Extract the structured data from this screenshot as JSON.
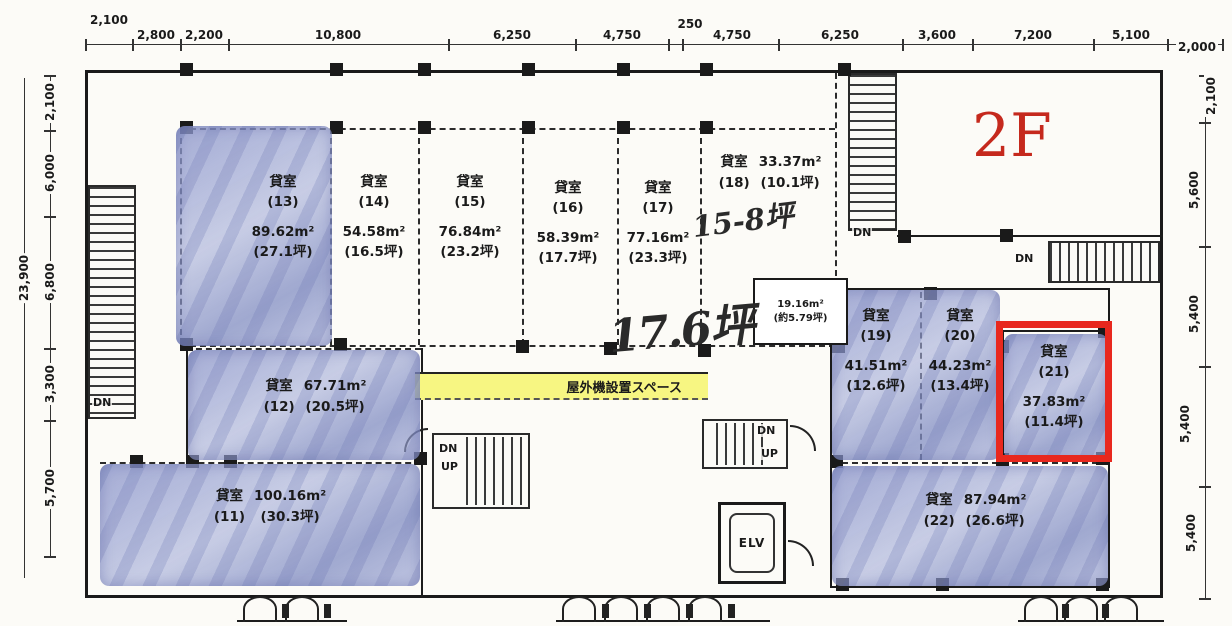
{
  "floor_label": "2F",
  "dimensions": {
    "top": [
      "2,100",
      "2,800",
      "2,200",
      "10,800",
      "6,250",
      "4,750",
      "250",
      "4,750",
      "6,250",
      "3,600",
      "7,200",
      "5,100",
      "2,000"
    ],
    "left": {
      "total": "23,900",
      "segments": [
        "2,100",
        "6,000",
        "6,800",
        "3,300",
        "5,700"
      ]
    },
    "right": {
      "segments": [
        "2,100",
        "5,600",
        "5,400",
        "5,400",
        "5,400"
      ]
    }
  },
  "labels": {
    "room_prefix": "貸室",
    "outdoor_unit_space": "屋外機設置スペース",
    "elevator": "ELV",
    "down": "DN",
    "up": "UP"
  },
  "rooms": [
    {
      "id": "13",
      "num": "(13)",
      "area": "89.62m²",
      "tsubo": "(27.1坪)",
      "highlighted": true,
      "selected": false
    },
    {
      "id": "14",
      "num": "(14)",
      "area": "54.58m²",
      "tsubo": "(16.5坪)",
      "highlighted": false,
      "selected": false
    },
    {
      "id": "15",
      "num": "(15)",
      "area": "76.84m²",
      "tsubo": "(23.2坪)",
      "highlighted": false,
      "selected": false
    },
    {
      "id": "16",
      "num": "(16)",
      "area": "58.39m²",
      "tsubo": "(17.7坪)",
      "highlighted": false,
      "selected": false
    },
    {
      "id": "17",
      "num": "(17)",
      "area": "77.16m²",
      "tsubo": "(23.3坪)",
      "highlighted": false,
      "selected": false
    },
    {
      "id": "18",
      "num": "(18)",
      "area": "33.37m²",
      "tsubo": "(10.1坪)",
      "highlighted": false,
      "selected": false
    },
    {
      "id": "19",
      "num": "(19)",
      "area": "41.51m²",
      "tsubo": "(12.6坪)",
      "highlighted": true,
      "selected": false
    },
    {
      "id": "20",
      "num": "(20)",
      "area": "44.23m²",
      "tsubo": "(13.4坪)",
      "highlighted": true,
      "selected": false
    },
    {
      "id": "21",
      "num": "(21)",
      "area": "37.83m²",
      "tsubo": "(11.4坪)",
      "highlighted": true,
      "selected": true
    },
    {
      "id": "22",
      "num": "(22)",
      "area": "87.94m²",
      "tsubo": "(26.6坪)",
      "highlighted": true,
      "selected": false
    },
    {
      "id": "12",
      "num": "(12)",
      "area": "67.71m²",
      "tsubo": "(20.5坪)",
      "highlighted": true,
      "selected": false
    },
    {
      "id": "11",
      "num": "(11)",
      "area": "100.16m²",
      "tsubo": "(30.3坪)",
      "highlighted": true,
      "selected": false
    }
  ],
  "small_room": {
    "area": "19.16m²",
    "tsubo": "(約5.79坪)"
  },
  "annotations": {
    "tsubo_note_18": "15-8坪",
    "tsubo_note_center": "17.6坪"
  },
  "colors": {
    "highlight_blue": "#a8b3d9",
    "selection_red": "#e8281e",
    "floor_label_red": "#c5291d",
    "outdoor_space_yellow": "#f7f682"
  }
}
